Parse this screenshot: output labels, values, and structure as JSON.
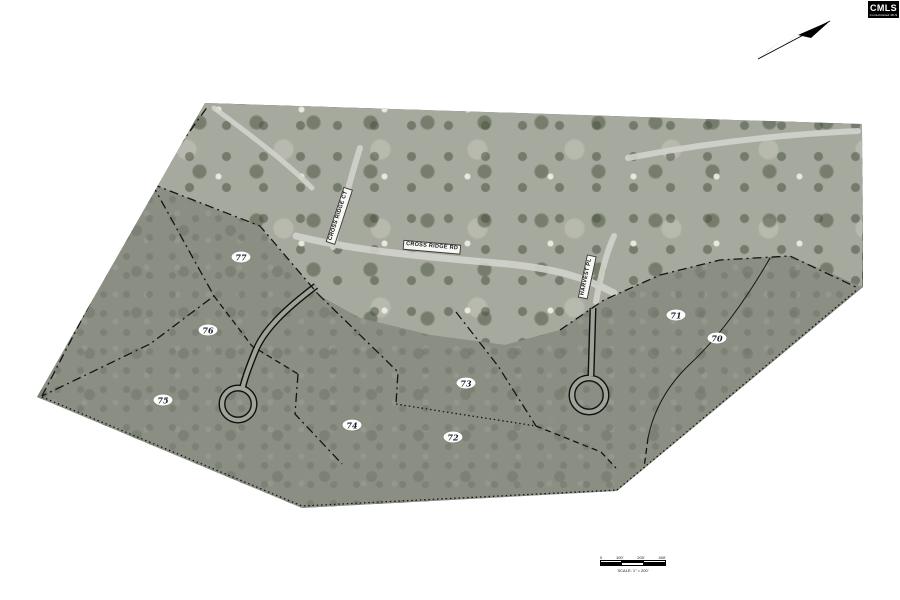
{
  "page": {
    "background": "#ffffff",
    "kind": "subdivision plat over aerial photo"
  },
  "logo": {
    "text": "CMLS",
    "subtext": "Consolidated MLS"
  },
  "north_arrow": {
    "icon": "northeast-arrow"
  },
  "map": {
    "road_labels": [
      {
        "id": "cross-ridge-rd",
        "name": "CROSS RIDGE RD"
      },
      {
        "id": "cross-ridge-ct",
        "name": "CROSS RIDGE CT"
      },
      {
        "id": "harvest-pl",
        "name": "HARVEST PL"
      }
    ],
    "lots": [
      {
        "number": "77"
      },
      {
        "number": "76"
      },
      {
        "number": "75"
      },
      {
        "number": "74"
      },
      {
        "number": "73"
      },
      {
        "number": "72"
      },
      {
        "number": "71"
      },
      {
        "number": "70"
      }
    ],
    "colors": {
      "trees": "#717768",
      "bright_area": "#a6aa9e",
      "overlay": "#999c94",
      "plat_line": "#141414",
      "label_bg": "#f7f7f4"
    }
  },
  "scalebar": {
    "ticks": [
      "0",
      "100'",
      "200'",
      "400'"
    ],
    "caption": "SCALE: 1\" = 200'"
  }
}
